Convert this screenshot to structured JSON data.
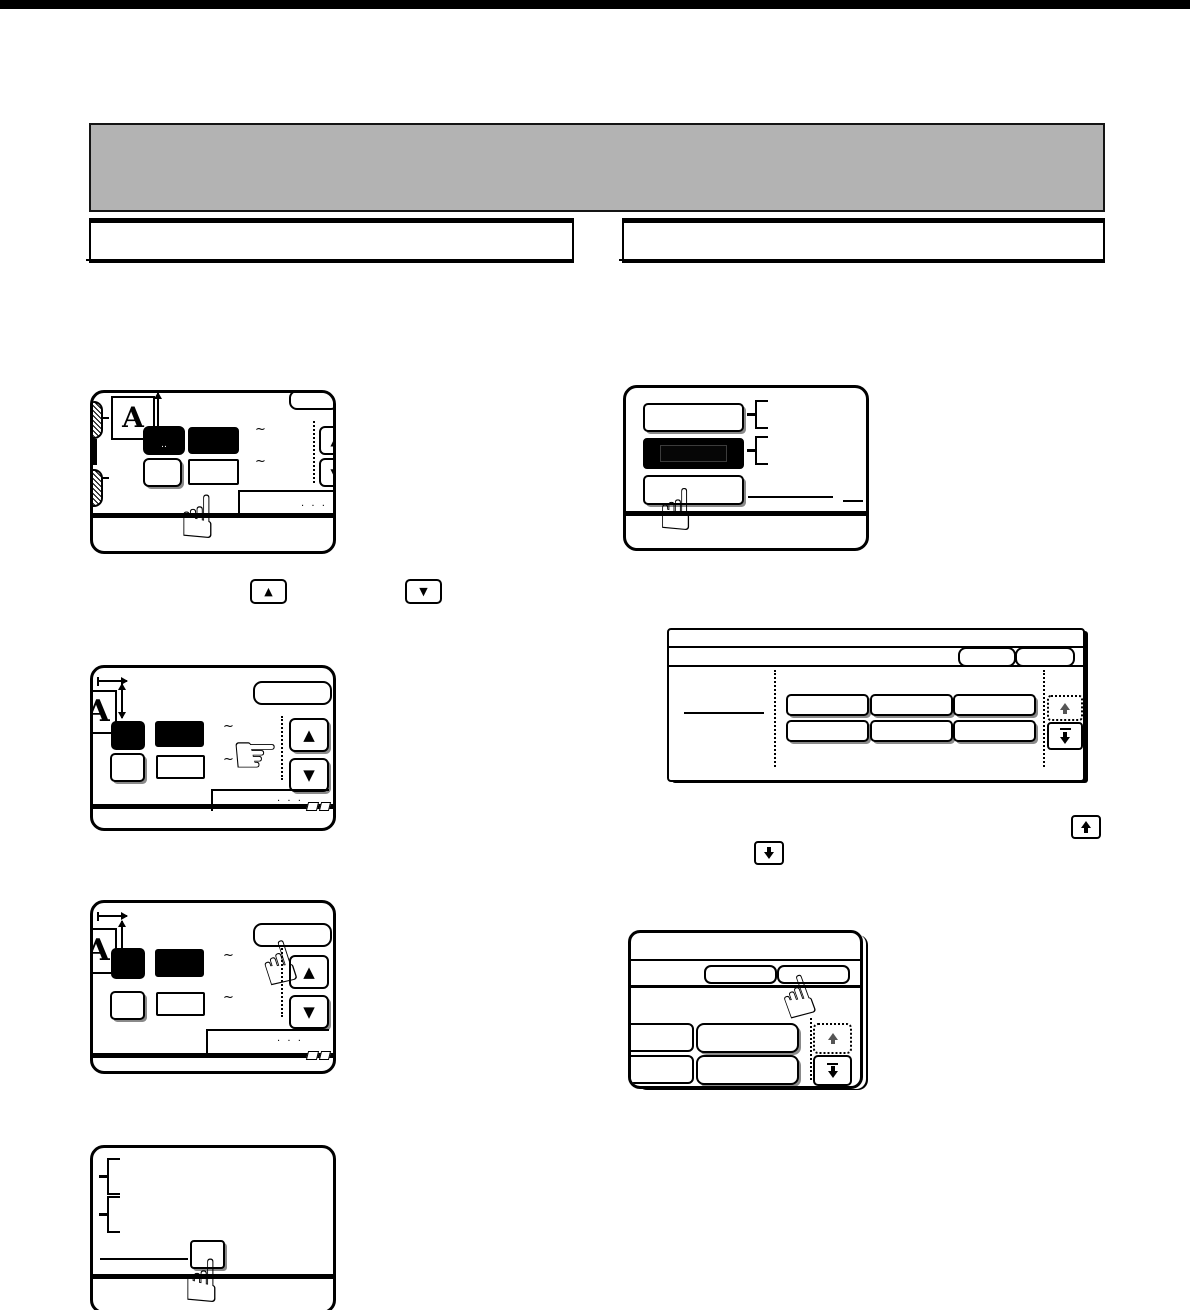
{
  "page": {
    "description": "Scanned copier operation-manual page: touch-panel instruction diagrams, text scrubbed",
    "header_banner": {
      "text": "",
      "bg": "#b3b3b3"
    },
    "column_headers": {
      "left": "",
      "right": ""
    },
    "ink_color": "#000000"
  },
  "glyphs": {
    "letter_a": "A",
    "tilde": "~",
    "ellipsis": ". . .",
    "button_dots": "..",
    "up_triangle": "▲",
    "down_triangle": "▼",
    "hand_point_up": "☝",
    "hand_point_right": "☞"
  }
}
